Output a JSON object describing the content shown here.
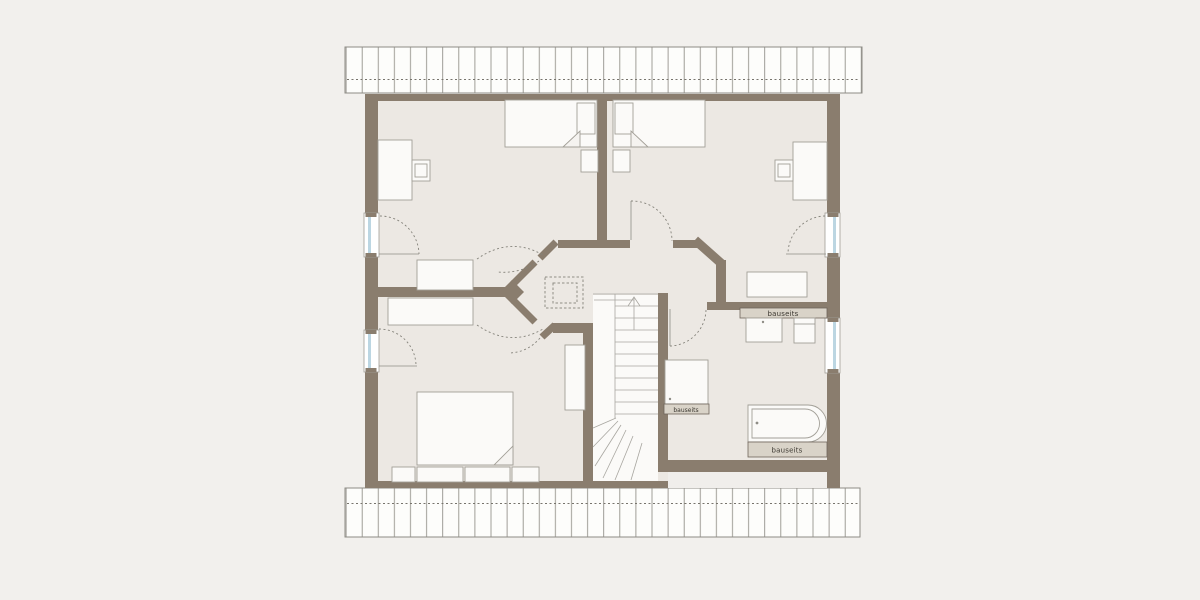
{
  "plan": {
    "labels": {
      "counter_top": "bauseits",
      "shower": "bauseits",
      "bathtub": "bauseits"
    },
    "colors": {
      "background": "#f2f0ed",
      "floor": "#ece8e3",
      "wall": "#8a7d6e",
      "counter_fill": "#d9d3c8",
      "window_glazing": "#bcd6e2",
      "drawing_line": "#8f8d86",
      "furniture_fill": "#fbfaf8"
    }
  }
}
